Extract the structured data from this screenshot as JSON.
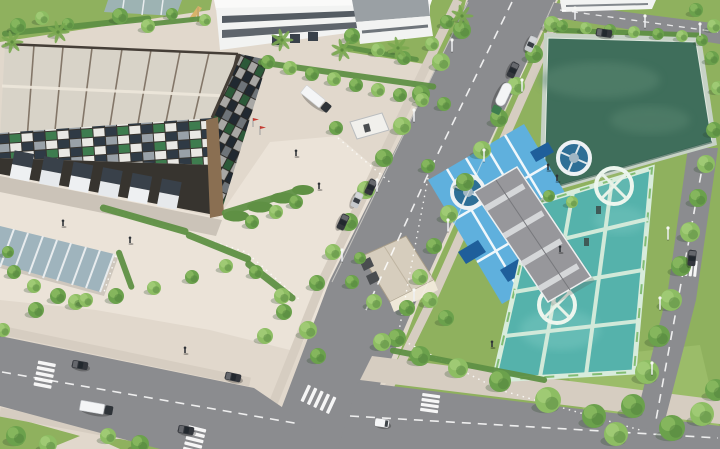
{
  "meta": {
    "description": "Aerial 3D architectural rendering of an industrial park: a large flat-roofed warehouse with a mosaic facade at top left, a white factory building at the top, a tree-lined boulevard running diagonally, a dark-green water reservoir at top right, a wastewater treatment plant with blue-decked clarifier tanks, a gray plant building and turquoise aeration pools at center right, a glass canopy shelter at lower left, and a road intersection with vehicles, crosswalks and trees at the bottom."
  },
  "palette": {
    "pavement": "#e1d8cc",
    "plaza": "#ebe3d8",
    "road": "#8b8c8f",
    "sidewalk": "#d6cdc1",
    "grass": "#8fb15e",
    "grasslight": "#a5c573",
    "grassdark": "#74994c",
    "hedge": "#5f9044",
    "treedark": "#4f7f3c",
    "treemid": "#6ba14c",
    "treelight": "#8dbd63",
    "roof": "#d8d3c8",
    "roofseam": "#6e5f51",
    "fascia": "#453e37",
    "facade": "#37342f",
    "mosaicwhite": "#e9e8e4",
    "mosaicnavy": "#2f3a45",
    "mosaicgreen": "#3e7c4f",
    "mosaicgray": "#99a1a8",
    "wood": "#8a6f52",
    "reservoir": "#3f6e5b",
    "reservoirlight": "#5b8872",
    "deckblue": "#5fb0dd",
    "deepblue": "#1f5f9b",
    "clarifier": "#2e6f96",
    "teal": "#55b2ab",
    "mint": "#d8ecdc",
    "wallgreen": "#79b868",
    "bldgray": "#97979b",
    "skylight": "#d9dbdd",
    "hutroof": "#d6cdbd",
    "hutwall": "#efe8d8",
    "canopy": "#9fb4bd",
    "factorywhite": "#f2f3f2",
    "windark": "#39414a",
    "vehwhite": "#f5f6f7",
    "vehdark": "#33363c",
    "vehsilver": "#c6c9cc",
    "cabgreen": "#3e7d4f",
    "flagred": "#c43c32"
  },
  "scene": {
    "hedges": [
      {
        "x": 2,
        "y": 34,
        "len": 150,
        "w": 6,
        "a": -6
      },
      {
        "x": 150,
        "y": 24,
        "len": 60,
        "w": 5,
        "a": -6
      },
      {
        "x": 258,
        "y": 62,
        "len": 180,
        "w": 6,
        "a": 8
      },
      {
        "x": 340,
        "y": 46,
        "len": 80,
        "w": 5,
        "a": 10
      },
      {
        "x": 100,
        "y": 207,
        "len": 92,
        "w": 7,
        "a": 16
      },
      {
        "x": 186,
        "y": 234,
        "len": 70,
        "w": 7,
        "a": 22
      },
      {
        "x": 246,
        "y": 262,
        "len": 62,
        "w": 7,
        "a": 38
      },
      {
        "x": 222,
        "y": 214,
        "len": 82,
        "w": 7,
        "a": -17
      },
      {
        "x": 552,
        "y": 30,
        "len": 150,
        "w": 5,
        "a": 2
      },
      {
        "x": 118,
        "y": 250,
        "len": 42,
        "w": 6,
        "a": 70
      },
      {
        "x": 390,
        "y": 350,
        "len": 160,
        "w": 6,
        "a": 11
      }
    ],
    "trees": [
      [
        18,
        26,
        8,
        1
      ],
      [
        42,
        18,
        7,
        2
      ],
      [
        68,
        24,
        6,
        1
      ],
      [
        120,
        16,
        8,
        1
      ],
      [
        148,
        26,
        7,
        2
      ],
      [
        172,
        14,
        6,
        1
      ],
      [
        205,
        20,
        6,
        2
      ],
      [
        462,
        30,
        9,
        1
      ],
      [
        441,
        62,
        9,
        2
      ],
      [
        421,
        94,
        9,
        1
      ],
      [
        402,
        126,
        9,
        2
      ],
      [
        384,
        158,
        9,
        1
      ],
      [
        366,
        190,
        9,
        2
      ],
      [
        349,
        222,
        9,
        1
      ],
      [
        333,
        252,
        8,
        2
      ],
      [
        317,
        283,
        8,
        1
      ],
      [
        552,
        24,
        8,
        2
      ],
      [
        534,
        54,
        9,
        1
      ],
      [
        516,
        86,
        9,
        2
      ],
      [
        499,
        118,
        9,
        1
      ],
      [
        482,
        150,
        9,
        2
      ],
      [
        465,
        182,
        9,
        1
      ],
      [
        449,
        214,
        9,
        2
      ],
      [
        434,
        246,
        8,
        1
      ],
      [
        420,
        277,
        8,
        2
      ],
      [
        407,
        308,
        8,
        1
      ],
      [
        352,
        36,
        8,
        1
      ],
      [
        378,
        50,
        7,
        2
      ],
      [
        404,
        58,
        7,
        1
      ],
      [
        432,
        44,
        7,
        2
      ],
      [
        447,
        22,
        7,
        1
      ],
      [
        268,
        62,
        7,
        1
      ],
      [
        290,
        68,
        7,
        2
      ],
      [
        312,
        74,
        7,
        1
      ],
      [
        334,
        79,
        7,
        2
      ],
      [
        356,
        85,
        7,
        1
      ],
      [
        378,
        90,
        7,
        2
      ],
      [
        400,
        95,
        7,
        1
      ],
      [
        422,
        100,
        7,
        2
      ],
      [
        444,
        104,
        7,
        1
      ],
      [
        562,
        26,
        6,
        1
      ],
      [
        586,
        28,
        6,
        2
      ],
      [
        610,
        30,
        6,
        1
      ],
      [
        634,
        32,
        6,
        2
      ],
      [
        658,
        34,
        6,
        1
      ],
      [
        682,
        36,
        6,
        2
      ],
      [
        702,
        40,
        6,
        1
      ],
      [
        712,
        58,
        7,
        1
      ],
      [
        718,
        88,
        7,
        2
      ],
      [
        549,
        196,
        6,
        1
      ],
      [
        572,
        202,
        6,
        2
      ],
      [
        714,
        130,
        8,
        1
      ],
      [
        706,
        164,
        9,
        2
      ],
      [
        698,
        198,
        9,
        1
      ],
      [
        690,
        232,
        10,
        2
      ],
      [
        681,
        266,
        10,
        1
      ],
      [
        671,
        300,
        11,
        2
      ],
      [
        659,
        336,
        11,
        1
      ],
      [
        647,
        372,
        12,
        2
      ],
      [
        633,
        406,
        12,
        1
      ],
      [
        616,
        434,
        12,
        2
      ],
      [
        672,
        428,
        13,
        1
      ],
      [
        702,
        414,
        12,
        2
      ],
      [
        716,
        390,
        11,
        1
      ],
      [
        397,
        338,
        9,
        1
      ],
      [
        374,
        302,
        8,
        2
      ],
      [
        352,
        282,
        7,
        1
      ],
      [
        308,
        330,
        9,
        2
      ],
      [
        284,
        312,
        8,
        1
      ],
      [
        265,
        336,
        8,
        2
      ],
      [
        318,
        356,
        8,
        1
      ],
      [
        382,
        342,
        9,
        2
      ],
      [
        420,
        356,
        10,
        1
      ],
      [
        458,
        368,
        10,
        2
      ],
      [
        500,
        381,
        11,
        1
      ],
      [
        548,
        400,
        13,
        2
      ],
      [
        594,
        416,
        12,
        1
      ],
      [
        36,
        310,
        8,
        1
      ],
      [
        76,
        302,
        8,
        2
      ],
      [
        116,
        296,
        8,
        1
      ],
      [
        154,
        288,
        7,
        2
      ],
      [
        192,
        277,
        7,
        1
      ],
      [
        226,
        266,
        7,
        2
      ],
      [
        256,
        272,
        7,
        1
      ],
      [
        282,
        296,
        8,
        2
      ],
      [
        14,
        272,
        7,
        1
      ],
      [
        34,
        286,
        7,
        2
      ],
      [
        58,
        296,
        8,
        1
      ],
      [
        86,
        300,
        7,
        2
      ],
      [
        8,
        252,
        6,
        1
      ],
      [
        16,
        436,
        10,
        1
      ],
      [
        48,
        444,
        9,
        2
      ],
      [
        140,
        444,
        9,
        1
      ],
      [
        108,
        436,
        8,
        2
      ],
      [
        3,
        330,
        7,
        2
      ],
      [
        696,
        10,
        7,
        1
      ],
      [
        714,
        26,
        7,
        2
      ],
      [
        252,
        222,
        7,
        1
      ],
      [
        276,
        212,
        7,
        2
      ],
      [
        296,
        202,
        7,
        1
      ],
      [
        336,
        128,
        7,
        1
      ],
      [
        360,
        258,
        6,
        1
      ],
      [
        430,
        300,
        8,
        2
      ],
      [
        446,
        318,
        8,
        1
      ],
      [
        428,
        166,
        7,
        1
      ]
    ],
    "palms": [
      [
        282,
        40
      ],
      [
        342,
        50
      ],
      [
        12,
        42
      ],
      [
        58,
        32
      ],
      [
        462,
        16
      ],
      [
        398,
        48
      ]
    ],
    "vehicles": [
      {
        "t": "car",
        "x": 513,
        "y": 70,
        "a": 115,
        "c": "vehdark"
      },
      {
        "t": "car",
        "x": 531,
        "y": 44,
        "a": 115,
        "c": "vehsilver"
      },
      {
        "t": "tanker",
        "x": 502,
        "y": 98,
        "a": 115,
        "c": "vehwhite"
      },
      {
        "t": "car",
        "x": 604,
        "y": 33,
        "a": 8,
        "c": "vehdark"
      },
      {
        "t": "car",
        "x": 371,
        "y": 187,
        "a": 115,
        "c": "vehdark"
      },
      {
        "t": "car",
        "x": 357,
        "y": 200,
        "a": 115,
        "c": "vehsilver"
      },
      {
        "t": "car",
        "x": 343,
        "y": 222,
        "a": 115,
        "c": "vehdark"
      },
      {
        "t": "truck",
        "x": 316,
        "y": 99,
        "a": 39,
        "c": "vehwhite"
      },
      {
        "t": "truck",
        "x": 96,
        "y": 408,
        "a": 10,
        "c": "vehwhite"
      },
      {
        "t": "car",
        "x": 80,
        "y": 365,
        "a": 10,
        "c": "vehdark"
      },
      {
        "t": "car",
        "x": 186,
        "y": 430,
        "a": 10,
        "c": "vehdark"
      },
      {
        "t": "car",
        "x": 233,
        "y": 377,
        "a": 12,
        "c": "vehdark"
      },
      {
        "t": "van",
        "x": 382,
        "y": 423,
        "a": 8,
        "c": "vehwhite"
      },
      {
        "t": "car",
        "x": 692,
        "y": 258,
        "a": 96,
        "c": "vehdark"
      }
    ],
    "people": [
      [
        63,
        226
      ],
      [
        130,
        243
      ],
      [
        296,
        156
      ],
      [
        319,
        189
      ],
      [
        185,
        353
      ],
      [
        548,
        170
      ],
      [
        557,
        181
      ],
      [
        560,
        252
      ],
      [
        492,
        347
      ]
    ],
    "lights": [
      [
        452,
        52
      ],
      [
        414,
        122
      ],
      [
        377,
        192
      ],
      [
        342,
        262
      ],
      [
        522,
        92
      ],
      [
        484,
        162
      ],
      [
        448,
        232
      ],
      [
        414,
        302
      ],
      [
        668,
        240
      ],
      [
        660,
        310
      ],
      [
        652,
        375
      ],
      [
        575,
        20
      ],
      [
        645,
        28
      ],
      [
        700,
        36
      ]
    ],
    "flags": [
      [
        253,
        127
      ],
      [
        260,
        135
      ]
    ]
  }
}
